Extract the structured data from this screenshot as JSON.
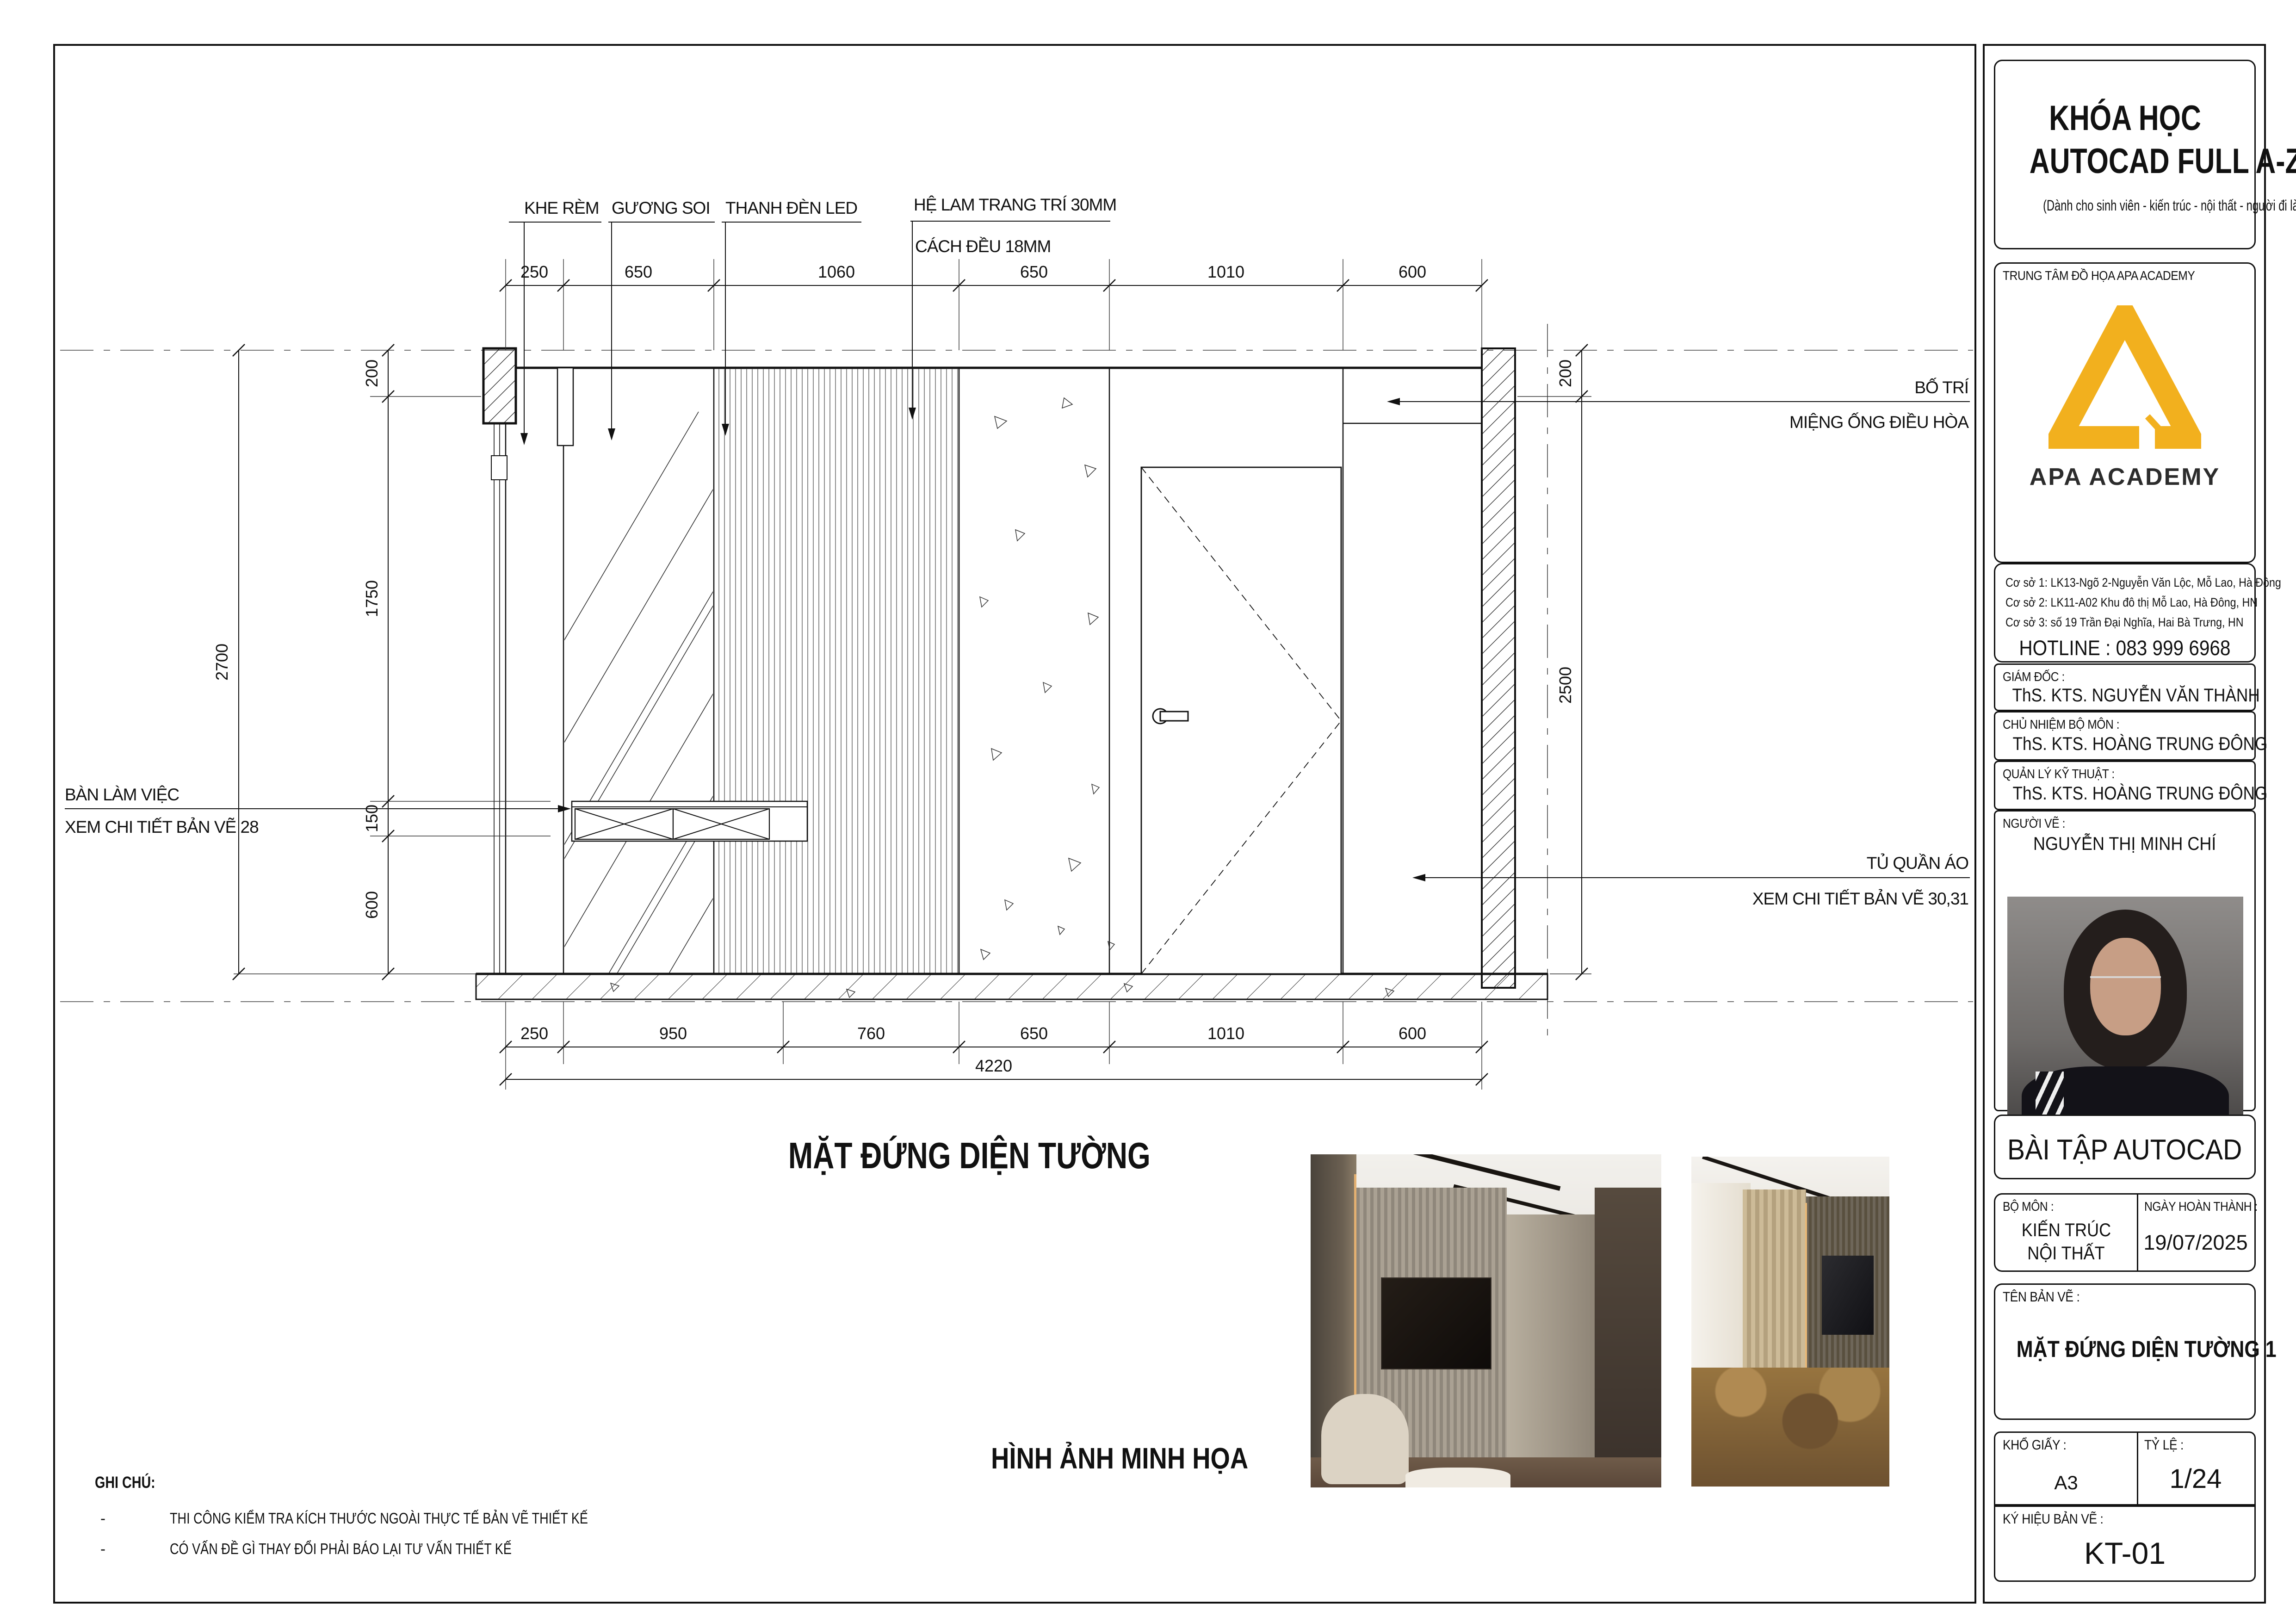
{
  "sheet": {
    "drawing_title": "MẶT ĐỨNG DIỆN TƯỜNG",
    "images_caption": "HÌNH ẢNH MINH HỌA",
    "notes": {
      "heading": "GHI CHÚ:",
      "bullet": "-",
      "items": [
        "THI CÔNG KIỂM TRA KÍCH THƯỚC NGOÀI THỰC TẾ BẢN VẼ THIẾT KẾ",
        "CÓ VẤN ĐỀ GÌ THAY ĐỔI PHẢI BÁO LẠI TƯ VẤN THIẾT KẾ"
      ]
    }
  },
  "elevation": {
    "callouts": {
      "khe_rem": "KHE RÈM",
      "guong_soi": "GƯƠNG SOI",
      "thanh_den_led": "THANH ĐÈN LED",
      "he_lam_line1": "HỆ LAM TRANG TRÍ 30MM",
      "he_lam_line2": "CÁCH ĐỀU 18MM",
      "ban_lam_viec_line1": "BÀN LÀM VIỆC",
      "ban_lam_viec_line2": "XEM CHI TIẾT BẢN VẼ 28",
      "bo_tri_line1": "BỐ TRÍ",
      "bo_tri_line2": "MIỆNG ỐNG ĐIỀU HÒA",
      "tu_quan_ao_line1": "TỦ QUẦN ÁO",
      "tu_quan_ao_line2": "XEM CHI TIẾT BẢN VẼ 30,31"
    },
    "dims_top": [
      "250",
      "650",
      "1060",
      "650",
      "1010",
      "600"
    ],
    "dims_bottom": [
      "250",
      "950",
      "760",
      "650",
      "1010",
      "600"
    ],
    "dim_total_width": "4220",
    "dims_left": [
      "200",
      "1750",
      "150",
      "600"
    ],
    "dim_total_height": "2700",
    "dims_right": [
      "200",
      "2500"
    ]
  },
  "title_block": {
    "course_title_line1": "KHÓA HỌC",
    "course_title_line2": "AUTOCAD FULL A-Z",
    "course_subtitle": "(Dành cho sinh viên  - kiến trúc - nội thất - người đi làm )",
    "center_label": "TRUNG TÂM ĐỒ HỌA APA ACADEMY",
    "logo_text": "APA ACADEMY",
    "accent_color": "#F2B01E",
    "addresses": [
      "Cơ sở 1: LK13-Ngõ 2-Nguyễn Văn Lộc, Mỗ Lao, Hà Đông",
      "Cơ sở 2: LK11-A02 Khu đô thị Mỗ Lao, Hà Đông, HN",
      "Cơ sở 3: số 19 Trần Đại Nghĩa, Hai Bà Trưng, HN"
    ],
    "hotline": "HOTLINE : 083 999 6968",
    "director_label": "GIÁM ĐỐC :",
    "director_name": "ThS. KTS. NGUYỄN VĂN THÀNH",
    "dept_head_label": "CHỦ NHIỆM BỘ MÔN :",
    "dept_head_name": "ThS. KTS. HOÀNG TRUNG ĐÔNG",
    "tech_manager_label": "QUẢN LÝ KỸ THUẬT :",
    "tech_manager_name": "ThS. KTS. HOÀNG TRUNG ĐÔNG",
    "drafter_label": "NGƯỜI VẼ :",
    "drafter_name": "NGUYỄN THỊ MINH CHÍ",
    "exercise_title": "BÀI TẬP AUTOCAD",
    "subject_label": "BỘ MÔN :",
    "subject_value_line1": "KIẾN TRÚC",
    "subject_value_line2": "NỘI THẤT",
    "completion_label": "NGÀY HOÀN THÀNH :",
    "completion_date": "19/07/2025",
    "sheet_name_label": "TÊN BẢN VẼ :",
    "sheet_name": "MẶT ĐỨNG DIỆN TƯỜNG 1",
    "paper_label": "KHỔ GIẤY :",
    "paper_size": "A3",
    "scale_label": "TỶ LỆ :",
    "scale_value": "1/24",
    "code_label": "KÝ HIỆU BẢN VẼ :",
    "code_value": "KT-01"
  }
}
